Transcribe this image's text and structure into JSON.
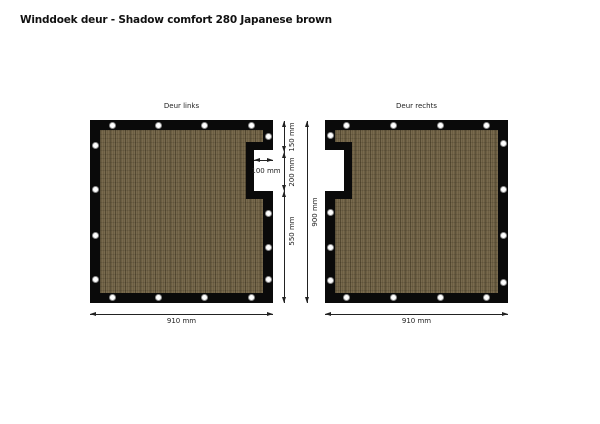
{
  "title": "Winddoek deur - Shadow comfort 280 Japanese brown",
  "colors": {
    "page_bg": "#ffffff",
    "panel_border": "#0a0a0a",
    "fabric_brown": "#6c5e42",
    "grommet": "#ffffff",
    "dimension_line": "#222222"
  },
  "panels": {
    "left": {
      "label": "Deur links",
      "width": "910 mm",
      "notch_width": "100 mm"
    },
    "right": {
      "label": "Deur rechts",
      "width": "910 mm"
    }
  },
  "dimensions": {
    "top_segment": "150 mm",
    "notch_height": "200 mm",
    "bottom_segment": "550 mm",
    "total_height": "900 mm"
  }
}
